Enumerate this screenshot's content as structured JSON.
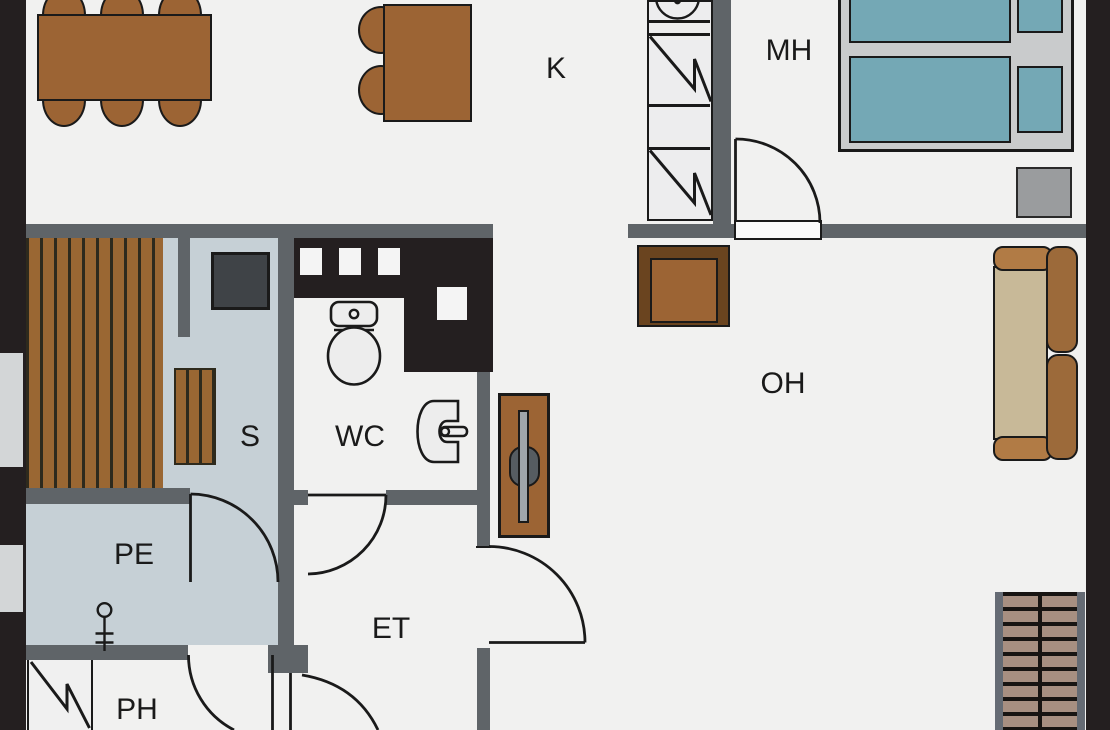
{
  "title": "apartment-floor-plan",
  "rooms": {
    "kitchen": {
      "label": "K"
    },
    "bedroom": {
      "label": "MH"
    },
    "living_room": {
      "label": "OH"
    },
    "sauna": {
      "label": "S"
    },
    "wc": {
      "label": "WC"
    },
    "washroom": {
      "label": "PE"
    },
    "entrance": {
      "label": "ET"
    },
    "utility": {
      "label": "PH"
    }
  },
  "palette": {
    "floor": "#f1f1f0",
    "wetfloor": "#c6d0d6",
    "window": "#d3d6d7",
    "wallgray": "#5f6468",
    "wallblack": "#241f20",
    "line": "#1a1a1a",
    "wood": "#9c6434",
    "wooddark": "#6a441f",
    "plankgap": "#2e2a1d",
    "bench": "#9a6733",
    "stove": "#3f4347",
    "teal": "#74a8b5",
    "bedframe": "#c9cbcc",
    "nightstand": "#9a9c9e",
    "sofaseat": "#c8b998",
    "sofaarm": "#b17b45",
    "sofaback": "#9c6a3a",
    "tread": "#a78f81",
    "stringer": "#656b74",
    "stairgap": "#171412",
    "fixture": "#ededed",
    "opening": "#fafafa"
  }
}
